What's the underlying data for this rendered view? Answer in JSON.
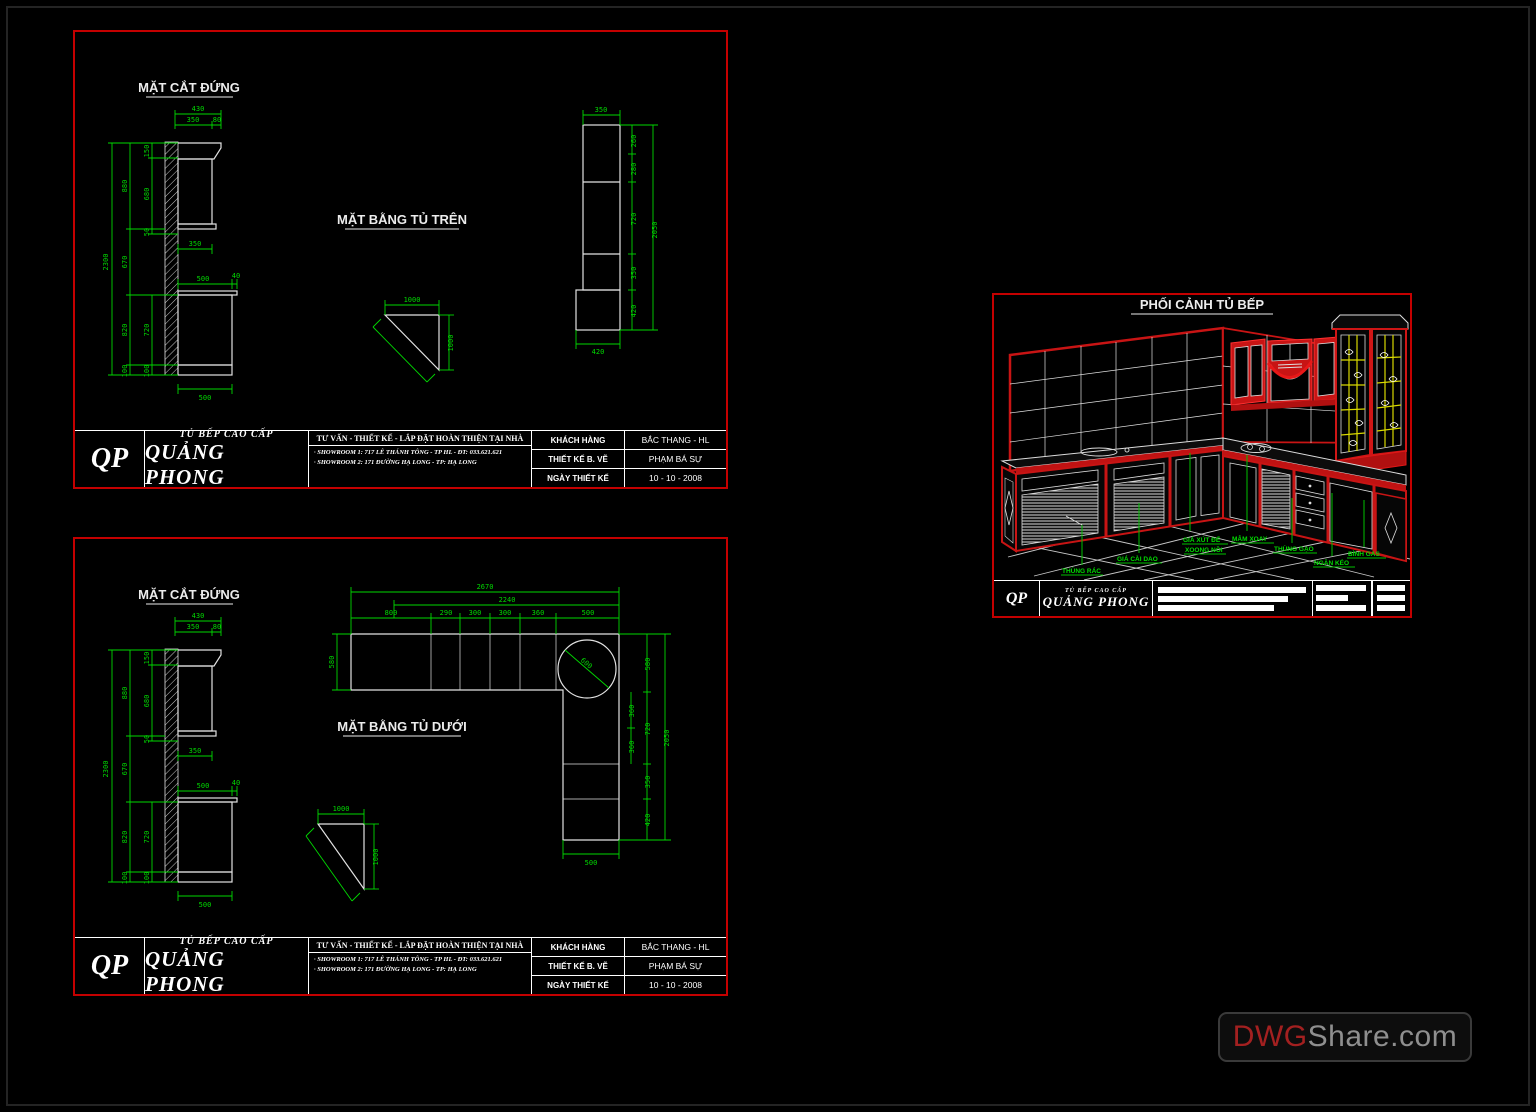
{
  "colors": {
    "panel_border": "#c40000",
    "cad_green": "#00d800",
    "cad_white": "#e2e2e2",
    "glass_yellow": "#d9d900",
    "persp_red": "#d01616"
  },
  "watermark": {
    "prefix": "DWG",
    "suffix": "Share.com"
  },
  "title_block": {
    "logo": "QP",
    "brand_small": "TỦ BẾP CAO CẤP",
    "brand": "QUẢNG PHONG",
    "consult": "TƯ VẤN - THIẾT KẾ - LẮP ĐẶT HOÀN THIỆN TẠI NHÀ",
    "showroom1": "· SHOWROOM 1: 717 LÊ THÁNH TÔNG - TP HL - ĐT: 033.621.621",
    "showroom2": "· SHOWROOM 2: 171 ĐƯỜNG HẠ LONG - TP: HẠ LONG",
    "rows": [
      {
        "label": "KHÁCH HÀNG",
        "value": "BẮC THANG - HL"
      },
      {
        "label": "THIẾT KẾ B. VẼ",
        "value": "PHẠM BÁ SỰ"
      },
      {
        "label": "NGÀY THIẾT KẾ",
        "value": "10 - 10 - 2008"
      }
    ]
  },
  "elev": {
    "title": "MẶT CẮT ĐỨNG",
    "top_total": "430",
    "top_a": "350",
    "top_b": "80",
    "h_total": "2300",
    "mid": [
      "880",
      "670",
      "820",
      "100"
    ],
    "inner": [
      "150",
      "680",
      "50",
      "720",
      "100"
    ],
    "shelf": "350",
    "counter_w": "500",
    "counter_edge": "40",
    "base_w": "500"
  },
  "plan_top": {
    "title": "MẶT BẰNG TỦ TRÊN",
    "w_top": "350",
    "w_bot": "420",
    "chain": [
      "260",
      "280",
      "720",
      "350",
      "420"
    ],
    "total": "2050"
  },
  "corner_unit": {
    "w": "1000",
    "h": "1000"
  },
  "plan_bottom": {
    "title": "MẶT BẰNG TỦ DƯỚI",
    "total": "2670",
    "sub_total": "2240",
    "segs": [
      "800",
      "290",
      "300",
      "300",
      "360",
      "500"
    ],
    "depth_left": "580",
    "sink_circle": "600",
    "right_sub": [
      "360",
      "360"
    ],
    "right_chain": [
      "580",
      "720",
      "350",
      "420"
    ],
    "right_total": "2050",
    "bottom_w": "500"
  },
  "persp": {
    "title": "PHỐI CẢNH TỦ BẾP",
    "labels": {
      "trash": "THÙNG RÁC",
      "knife": "GIÁ CÀI DAO",
      "pot_rack_1": "GIÁ XÚT ĐỂ",
      "pot_rack_2": "XOONG NỒI",
      "tray": "MÂM XOAY",
      "rice": "THÙNG GẠO",
      "drawer": "NGĂN KÉO",
      "gas": "BÌNH GAS"
    }
  }
}
